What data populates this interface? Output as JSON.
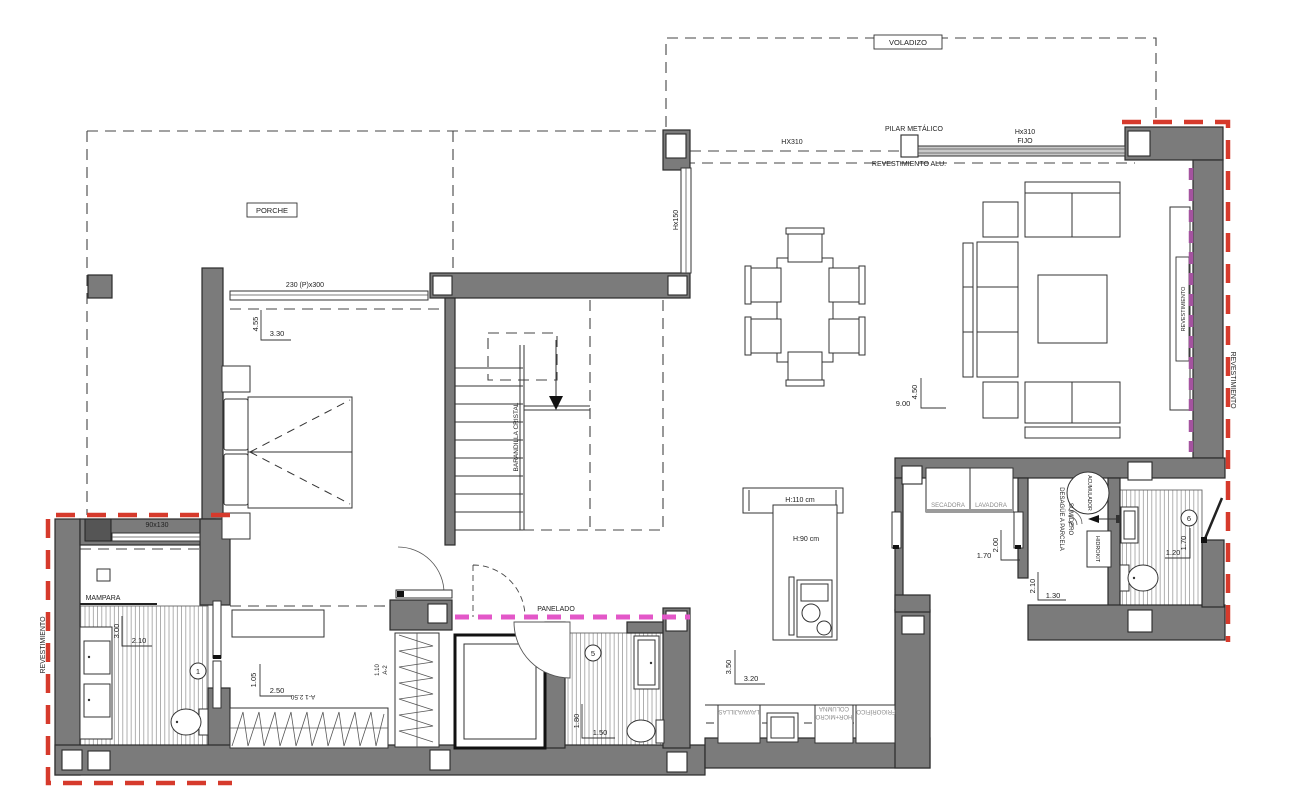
{
  "plan": {
    "title": "Floor plan drawing",
    "area_labels": {
      "voladizo": "VOLADIZO",
      "porche": "PORCHE"
    },
    "annotations": {
      "pilar_metalico": "PILAR METÁLICO",
      "fijo_l1": "Hx310",
      "fijo_l2": "FIJO",
      "hx310": "HX310",
      "revestimiento_alu": "REVESTIMIENTO ALU.",
      "hx150": "Hx150",
      "barandilla_cristal": "BARANDILLA CRISTAL",
      "panelado": "PANELADO",
      "mampara": "MAMPARA",
      "rev_left": "REVESTIMIENTO",
      "rev_right_outer": "REVESTIMIENTO",
      "rev_tv": "REVESTIMIENTO",
      "secadora": "SECADORA",
      "lavadora": "LAVADORA",
      "sumidero": "SUMIDERO",
      "desague": "DESAGÜE A PARCELA",
      "acumulador": "ACUMULADOR",
      "hidrokit": "HIDROKIT",
      "lavavajillas": "LAVAVAJILLAS",
      "columna": "COLUMNA",
      "hor_micro": "HOR+MICRO",
      "frigorifico": "FRIGORÍFICO",
      "h110": "H:110 cm",
      "h90": "H:90 cm",
      "win_230": "230 (P)x300",
      "win_90": "90x130",
      "a1_row": "A-1  2.50",
      "a2": "A-2",
      "a2_dim": "1.10"
    },
    "room_numbers": {
      "n1": "1",
      "n5": "5",
      "n6": "6"
    },
    "dimensions": {
      "porch_v": "4.55",
      "porch_h": "3.30",
      "living_w": "9.00",
      "living_d": "4.50",
      "laundry_w": "1.70",
      "laundry_d": "2.00",
      "tech_d": "2.10",
      "tech_w": "1.30",
      "bath6_d": "1.70",
      "bath6_w": "1.20",
      "bath1_d": "3.00",
      "bath1_w": "2.10",
      "dress_d": "1.05",
      "dress_w": "2.50",
      "bath5_d": "1.80",
      "bath5_w": "1.50",
      "kitchen_d": "3.50",
      "kitchen_w": "3.20"
    },
    "colors": {
      "wall": "#7b7b7b",
      "red_dash": "#d63a2c",
      "pink_dash": "#e357c8",
      "purple_dash": "#a4539f"
    }
  }
}
